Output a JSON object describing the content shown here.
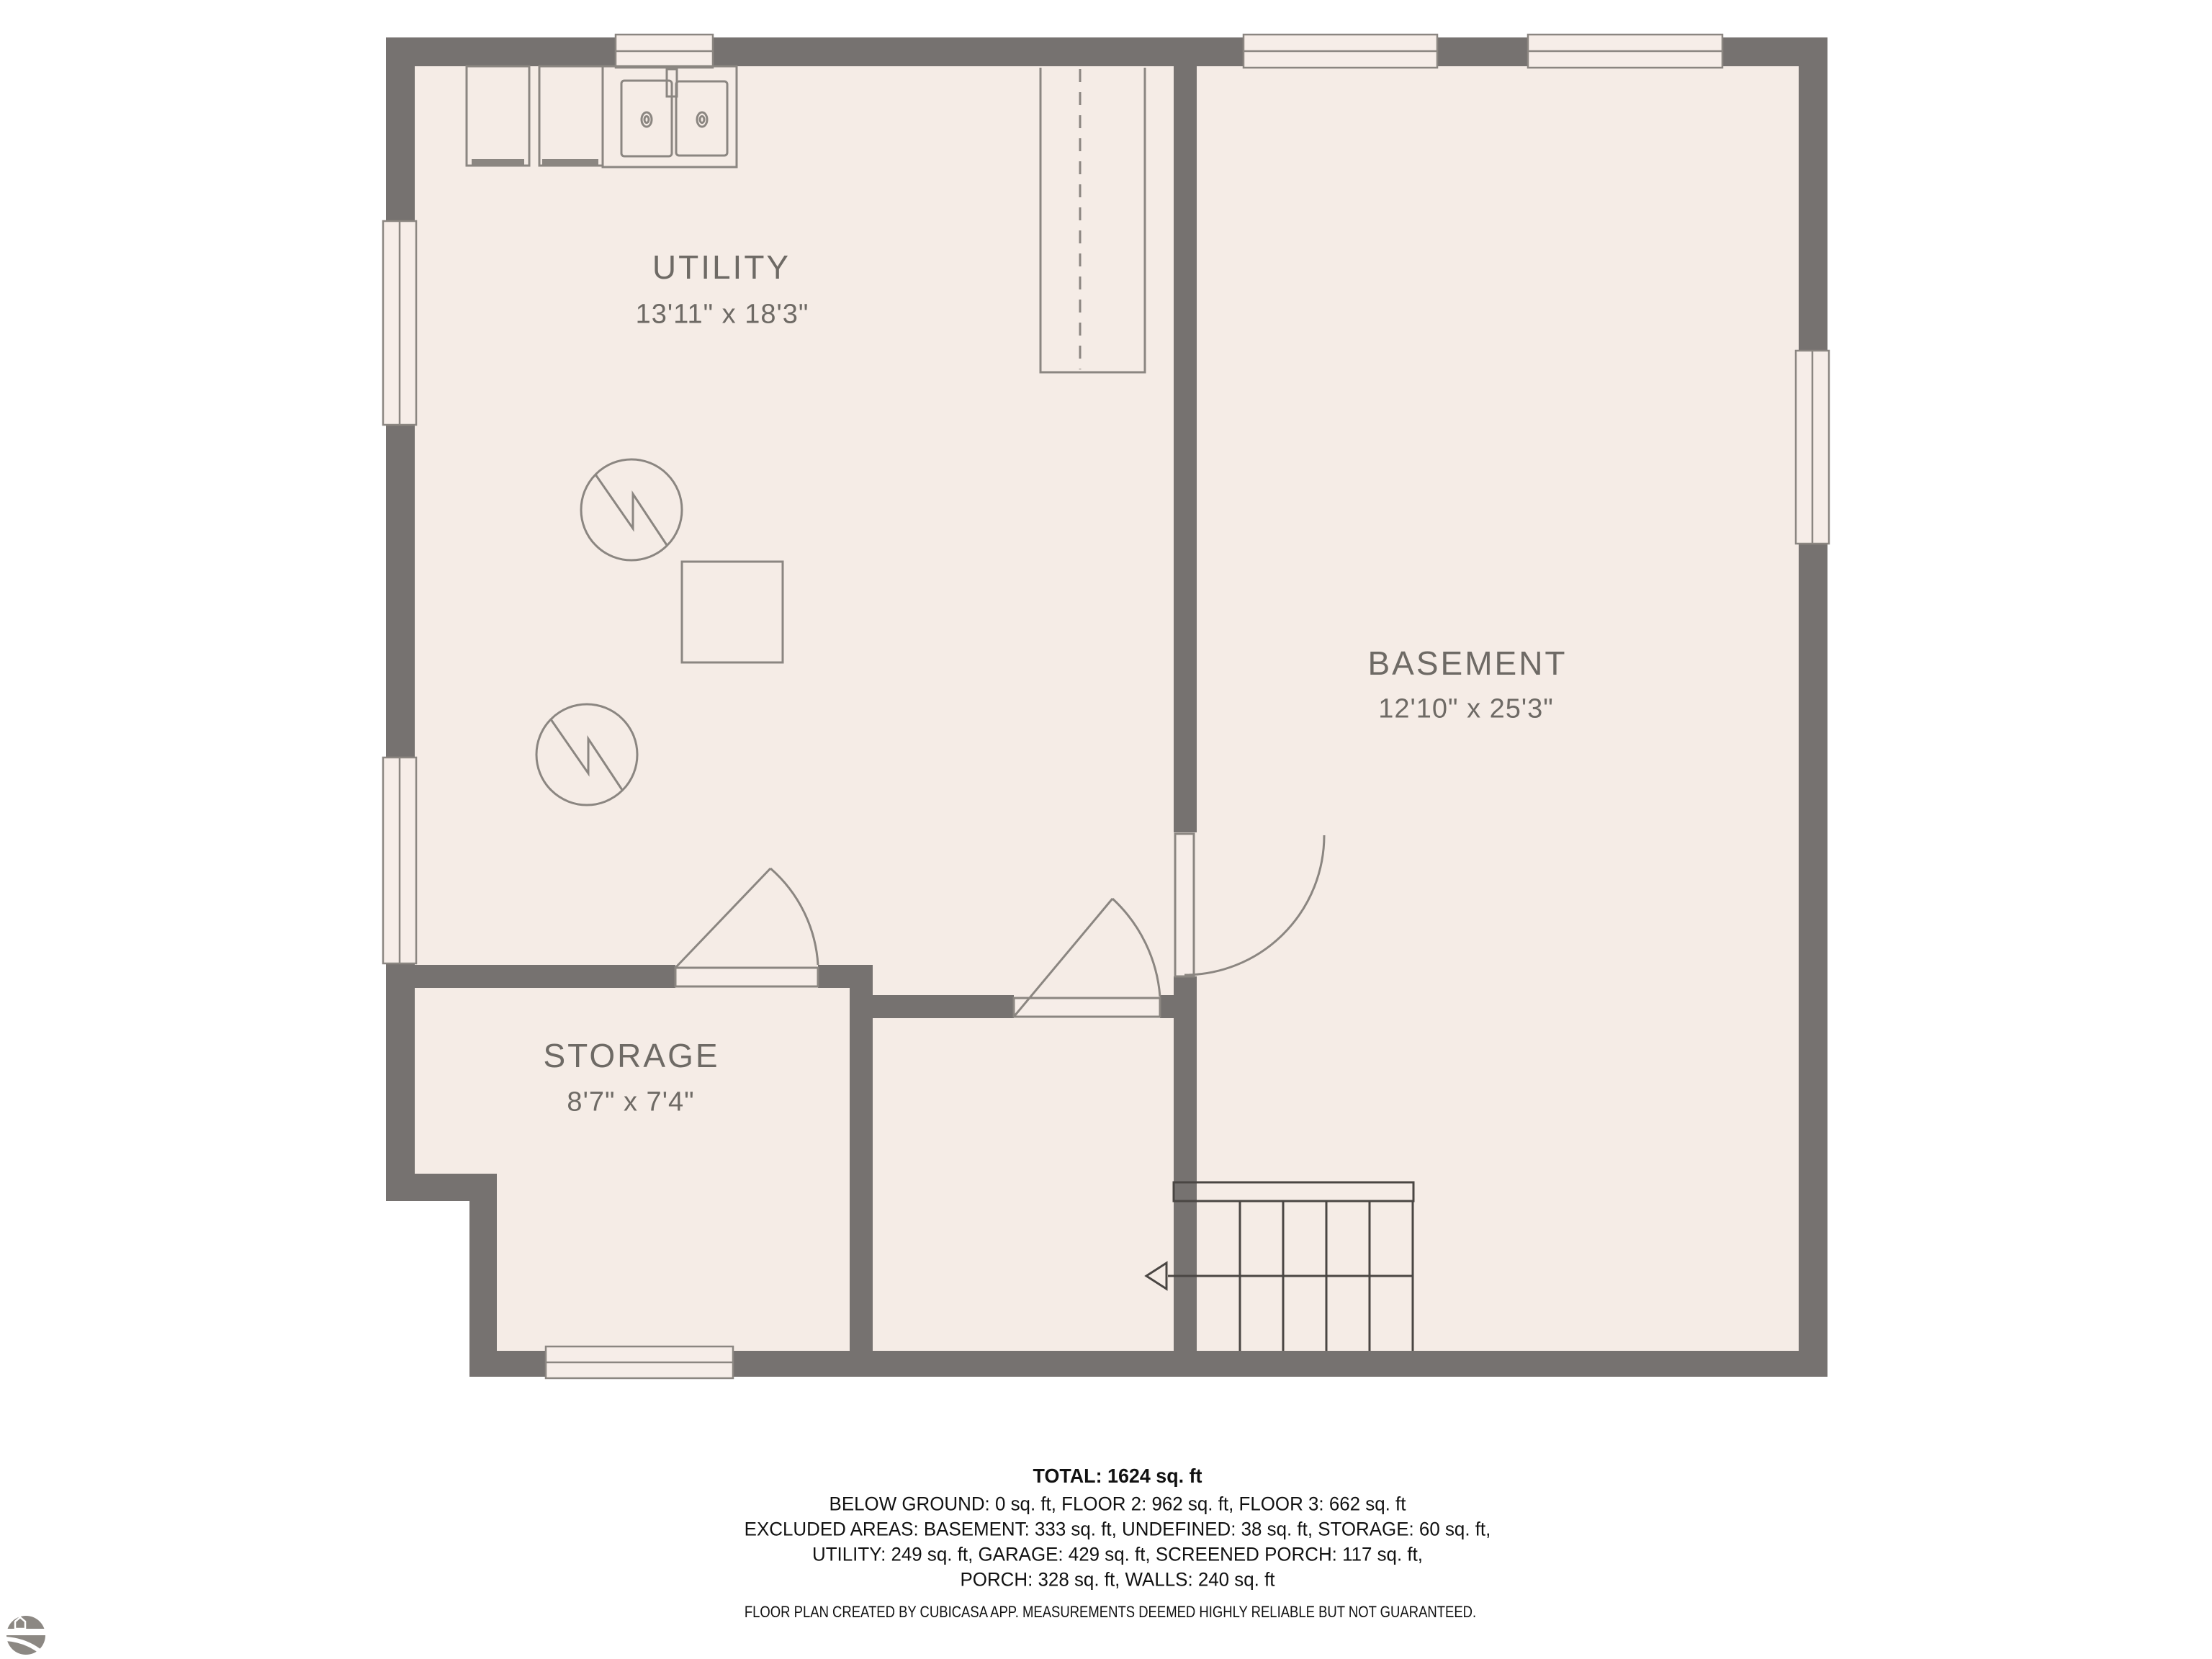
{
  "page": {
    "background": "#ffffff"
  },
  "floorplan": {
    "floor_color": "#f5ece6",
    "wall_color": "#767270",
    "outline_color": "#8b8681",
    "stairs_color": "#4a4643",
    "label_color": "#6e6a65",
    "rooms": [
      {
        "name": "UTILITY",
        "dims": "13'11\" x 18'3\""
      },
      {
        "name": "BASEMENT",
        "dims": "12'10\" x 25'3\""
      },
      {
        "name": "STORAGE",
        "dims": "8'7\" x 7'4\""
      }
    ],
    "symbols": [
      "washer",
      "dryer",
      "double-sink",
      "furnace",
      "furnace",
      "floor-drain-square",
      "stairs-down-arrow"
    ]
  },
  "summary": {
    "total": "TOTAL: 1624 sq. ft",
    "line_floors": "BELOW GROUND: 0 sq. ft, FLOOR 2: 962 sq. ft, FLOOR 3: 662 sq. ft",
    "line_excluded_1": "EXCLUDED AREAS: BASEMENT: 333 sq. ft, UNDEFINED: 38 sq. ft, STORAGE: 60 sq. ft,",
    "line_excluded_2": "UTILITY: 249 sq. ft, GARAGE: 429 sq. ft, SCREENED PORCH: 117 sq. ft,",
    "line_excluded_3": "PORCH: 328 sq. ft, WALLS: 240 sq. ft",
    "disclaimer": "FLOOR PLAN CREATED BY CUBICASA APP. MEASUREMENTS DEEMED HIGHLY RELIABLE BUT NOT GUARANTEED."
  },
  "branding": {
    "logo": "cubicasa-logo"
  }
}
